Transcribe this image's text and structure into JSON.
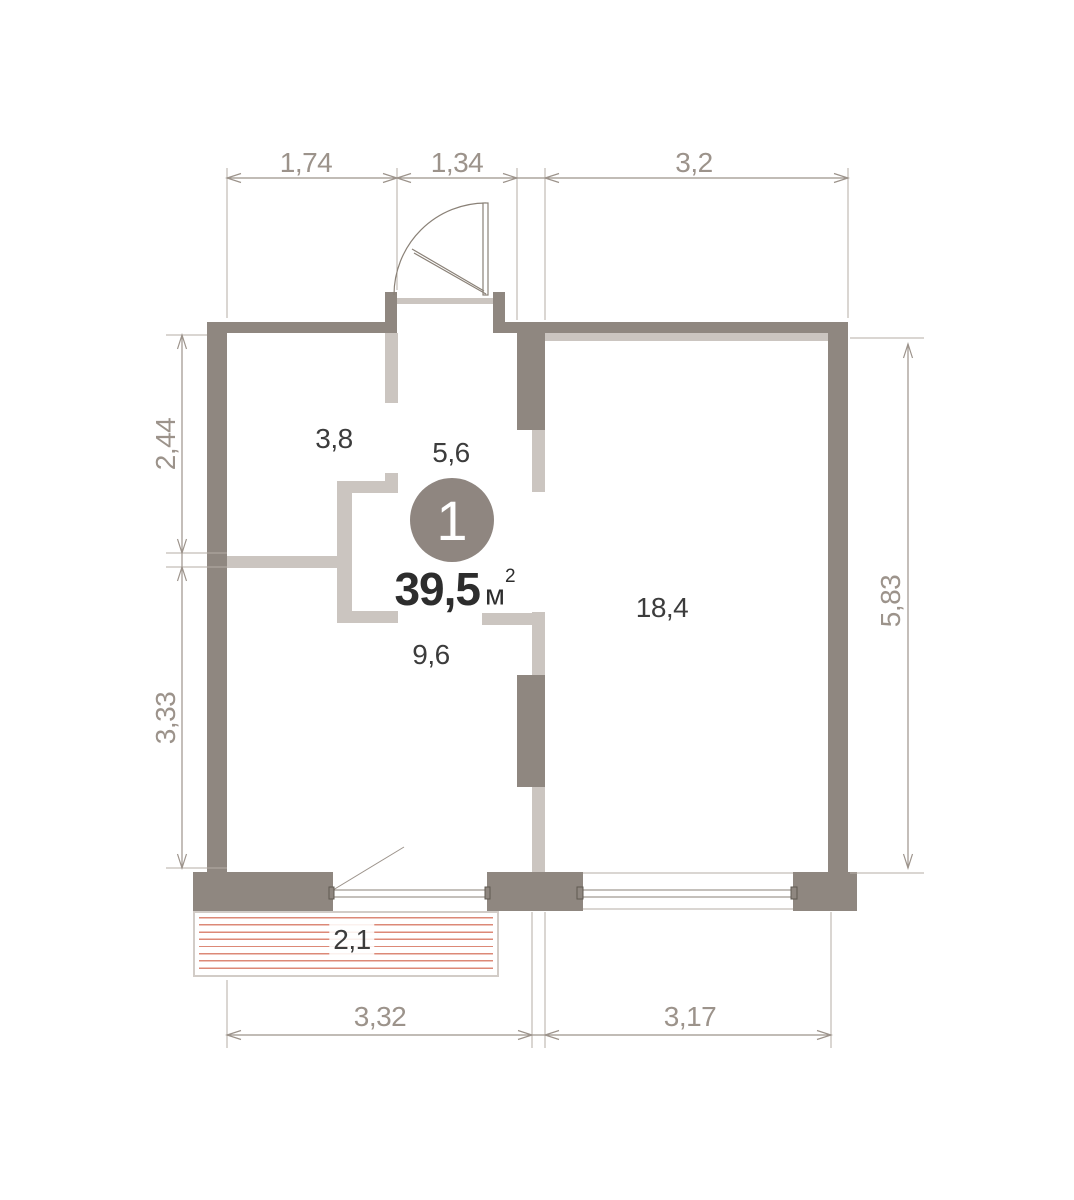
{
  "plan": {
    "badge": {
      "number": "1"
    },
    "total_area": {
      "value": "39,5",
      "unit": "м",
      "superscript": "2"
    },
    "rooms": [
      {
        "name": "room-top-left",
        "area": "3,8"
      },
      {
        "name": "hallway",
        "area": "5,6"
      },
      {
        "name": "kitchen",
        "area": "9,6"
      },
      {
        "name": "living-room",
        "area": "18,4"
      },
      {
        "name": "balcony",
        "area": "2,1"
      }
    ],
    "dimensions": {
      "top": [
        {
          "label": "1,74"
        },
        {
          "label": "1,34"
        },
        {
          "label": "3,2"
        }
      ],
      "left": [
        {
          "label": "2,44"
        },
        {
          "label": "3,33"
        }
      ],
      "right": [
        {
          "label": "5,83"
        }
      ],
      "bottom": [
        {
          "label": "3,32"
        },
        {
          "label": "3,17"
        }
      ]
    },
    "colors": {
      "wall_dark": "#8f8780",
      "wall_light": "#cbc5c0",
      "dimension_line": "#9c938b",
      "room_label": "#3c3c3c",
      "balcony_hatch": "#dc8977",
      "badge_fill": "#8f8680"
    }
  }
}
